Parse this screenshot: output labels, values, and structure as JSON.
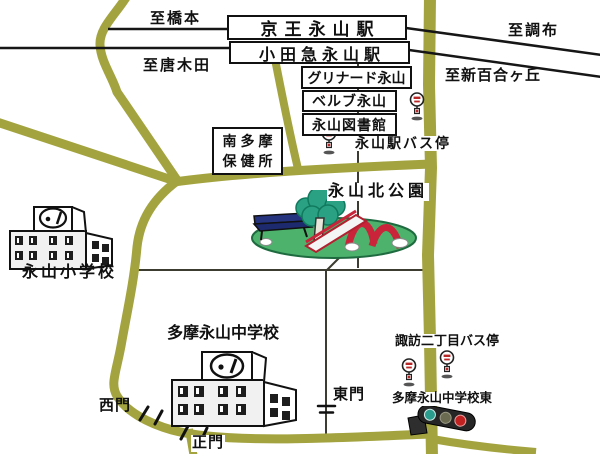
{
  "map": {
    "directions": {
      "hashimoto": "至橋本",
      "chofu": "至調布",
      "karakida": "至唐木田",
      "shin_yurigaoka": "至新百合ヶ丘"
    },
    "stations": {
      "keio": "京王永山駅",
      "odakyu": "小田急永山駅"
    },
    "landmarks": {
      "grinard": "グリナード永山",
      "belb": "ベルブ永山",
      "library": "永山図書館",
      "health_center": [
        "南多摩",
        "保健所"
      ],
      "park": "永山北公園",
      "elementary_school": "永山小学校",
      "junior_high_school": "多摩永山中学校"
    },
    "bus_stops": {
      "nagayama_station": "永山駅バス停",
      "suwa_2chome": "諏訪二丁目バス停"
    },
    "gates": {
      "west": "西門",
      "main": "正門",
      "east": "東門"
    },
    "intersections": {
      "school_east": "多摩永山中学校東"
    },
    "icons": {
      "bus_stop": "bus-stop-sign-icon",
      "traffic_light": "traffic-light-icon",
      "school_building": "school-building-icon",
      "park_tree": "tree-icon",
      "park_bench": "bench-icon",
      "park_slide": "slide-icon",
      "gate_tick": "gate-tick-icon"
    },
    "colors": {
      "road": "#a3a43f",
      "railway": "#161616",
      "minor_line": "#3c3c30",
      "park_ground": "#4cb26c",
      "tree": "#2aa183",
      "slide_red": "#c9243a",
      "bench_blue": "#26337f",
      "signal_green": "#2a9d8f",
      "signal_red": "#c02222",
      "bus_mark_red": "#b82828",
      "building_face": "#f1f1f1"
    }
  }
}
